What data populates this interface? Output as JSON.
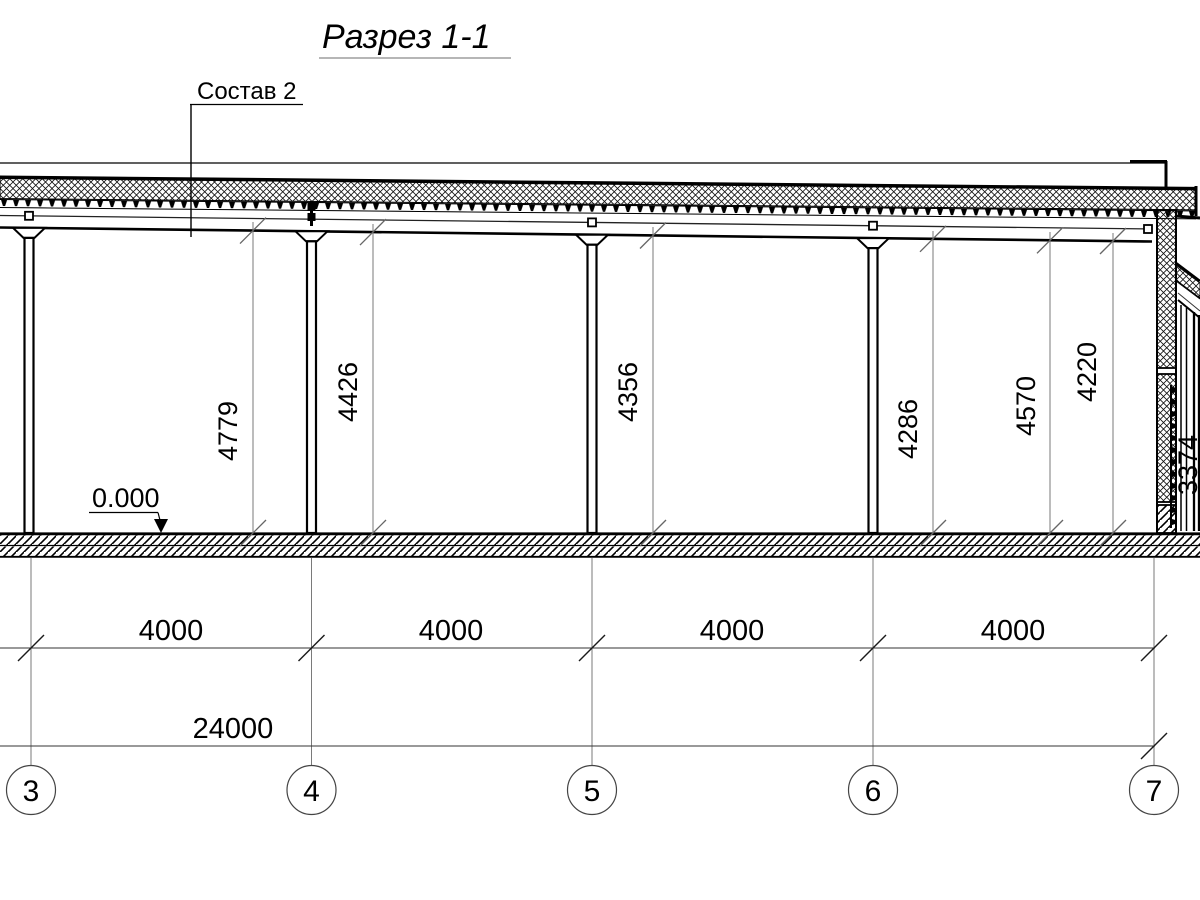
{
  "drawing": {
    "title": "Разрез 1-1",
    "composition_label": "Состав 2",
    "elevation_mark": "0.000",
    "height_dimensions": [
      "4779",
      "4426",
      "4356",
      "4286",
      "4570",
      "4220"
    ],
    "partial_right_dimension": "3374",
    "bay_dimensions": [
      "4000",
      "4000",
      "4000",
      "4000"
    ],
    "total_dimension": "24000",
    "axis_labels": [
      "3",
      "4",
      "5",
      "6",
      "7"
    ],
    "colors": {
      "ink": "#000000",
      "dimension_line": "#7a7a7a",
      "background": "#ffffff"
    }
  }
}
